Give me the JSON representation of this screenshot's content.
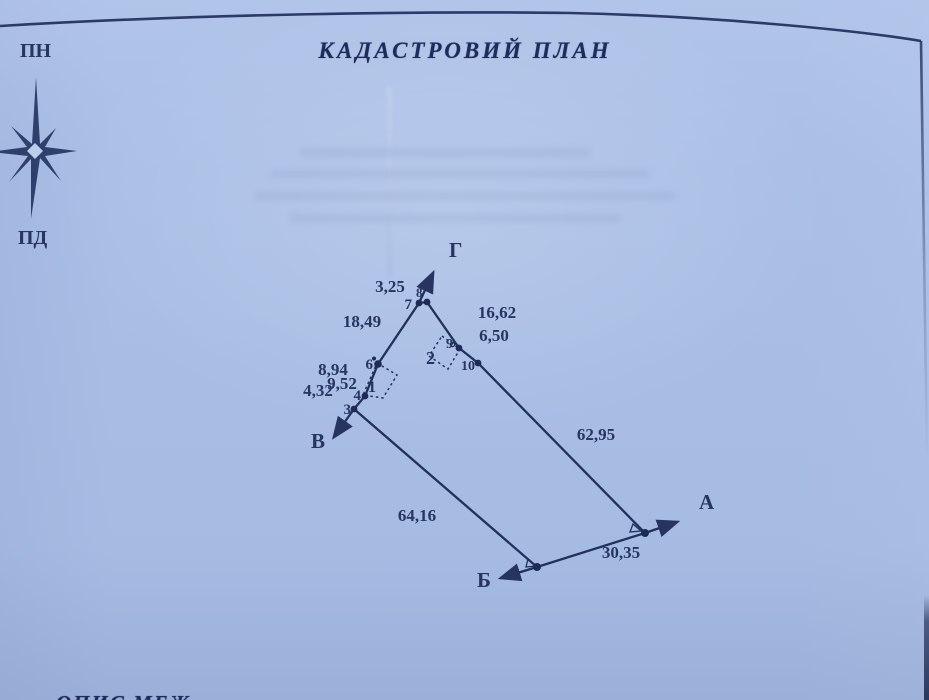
{
  "title": "КАДАСТРОВИЙ ПЛАН",
  "compass": {
    "north": "ПН",
    "south": "ПД"
  },
  "plan": {
    "corners": {
      "a": "А",
      "b": "Б",
      "v": "В",
      "g": "Г"
    },
    "points": {
      "p3": "3",
      "p4": "4",
      "p6": "6",
      "p7": "7",
      "p8": "8",
      "p9": "9",
      "p10": "10"
    },
    "structures": {
      "s1": "1",
      "s2": "2"
    },
    "lengths": {
      "seg_7_8": "3,25",
      "seg_8_9": "16,62",
      "seg_9_10": "6,50",
      "seg_6_7": "18,49",
      "seg_5_6": "8,94",
      "seg_4_5": "9,52",
      "seg_3_4": "4,32",
      "seg_10_a": "62,95",
      "seg_3_b": "64,16",
      "seg_b_a": "30,35"
    }
  },
  "footer": {
    "partial_text": "ОПИС МЕЖ"
  },
  "colors": {
    "ink": "#24335e",
    "paper": "#aabfe6"
  }
}
